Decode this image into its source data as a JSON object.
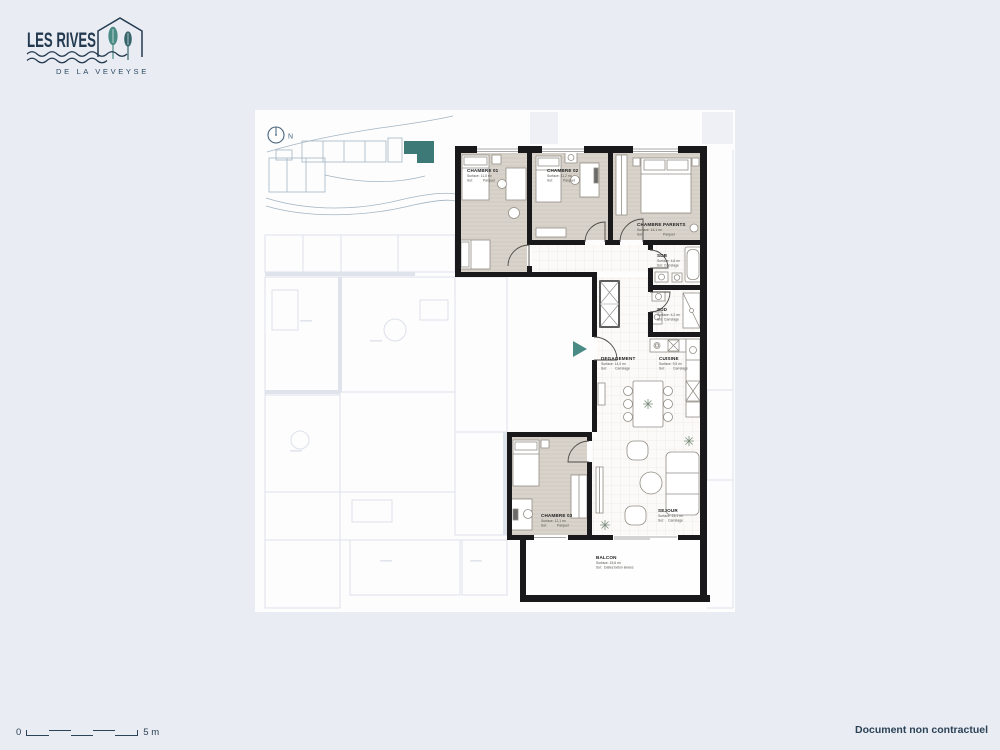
{
  "brand": {
    "name": "LES RIVES",
    "subtitle": "DE LA VEVEYSE",
    "navy": "#22394f",
    "teal": "#4a8b86"
  },
  "compass": {
    "label": "N"
  },
  "plan": {
    "entrance_arrow_color": "#4a8b86",
    "wall_color": "#19191b",
    "parquet_color": "#d9d4cb",
    "tile_color": "#fbfaf8",
    "rooms": [
      {
        "id": "chambre-01",
        "name": "CHAMBRE 01",
        "surface": "Surface: 11,0 m²",
        "sol_label": "Sol:",
        "sol_value": "Parquet"
      },
      {
        "id": "chambre-02",
        "name": "CHAMBRE 02",
        "surface": "Surface: 11,2 m²",
        "sol_label": "Sol:",
        "sol_value": "Parquet"
      },
      {
        "id": "chambre-parents",
        "name": "CHAMBRE PARENTS",
        "surface": "Surface: 14,1 m²",
        "sol_label": "Sol:",
        "sol_value": "Parquet"
      },
      {
        "id": "sdb",
        "name": "SDB",
        "surface": "Surface: 4,6 m²",
        "sol_label": "Sol:",
        "sol_value": "Carrelage"
      },
      {
        "id": "sdd",
        "name": "SDD",
        "surface": "Surface: 4,2 m²",
        "sol_label": "Sol:",
        "sol_value": "Carrelage"
      },
      {
        "id": "degagement",
        "name": "DEGAGEMENT",
        "surface": "Surface: 14,0 m²",
        "sol_label": "Sol:",
        "sol_value": "Carrelage"
      },
      {
        "id": "cuisine",
        "name": "CUISINE",
        "surface": "Surface: 9,5 m²",
        "sol_label": "Sol:",
        "sol_value": "Carrelage"
      },
      {
        "id": "chambre-03",
        "name": "CHAMBRE 03",
        "surface": "Surface: 12,1 m²",
        "sol_label": "Sol:",
        "sol_value": "Parquet"
      },
      {
        "id": "sejour",
        "name": "SEJOUR",
        "surface": "Surface: 23,1 m²",
        "sol_label": "Sol:",
        "sol_value": "Carrelage"
      },
      {
        "id": "balcon",
        "name": "BALCON",
        "surface": "Surface: 15,6 m²",
        "sol_label": "Sol:",
        "sol_value": "Dalles béton lavées"
      }
    ]
  },
  "footer": {
    "scale_zero": "0",
    "scale_five": "5 m",
    "disclaimer": "Document non contractuel"
  }
}
